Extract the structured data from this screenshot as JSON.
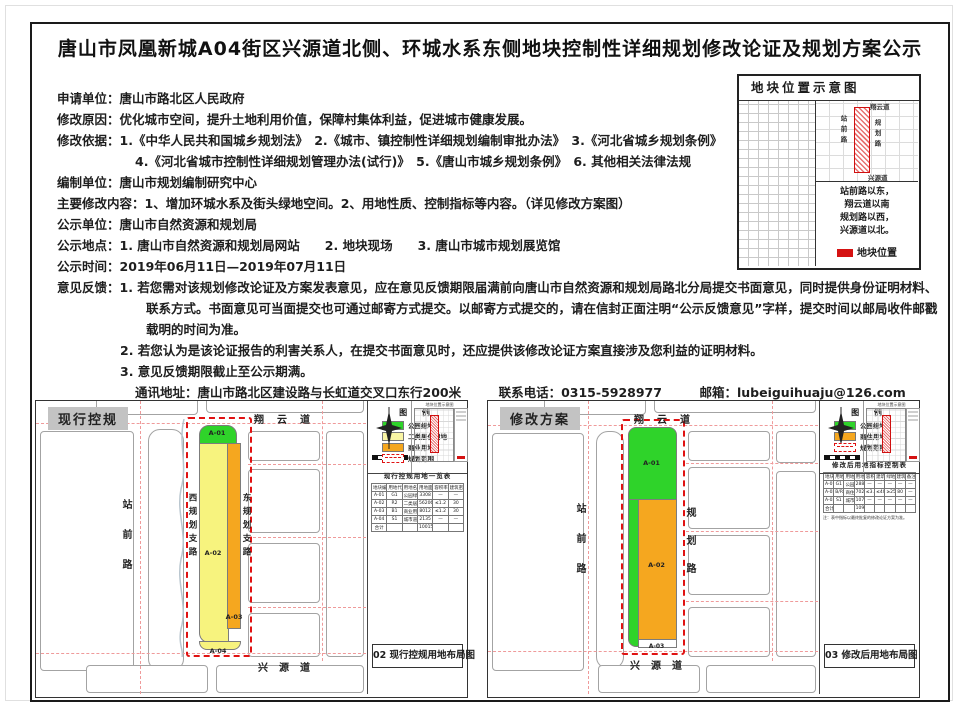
{
  "page": {
    "title": "唐山市凤凰新城A04街区兴源道北侧、环城水系东侧地块控制性详细规划修改论证及规划方案公示"
  },
  "body": {
    "lines": [
      {
        "text": "申请单位：唐山市路北区人民政府"
      },
      {
        "text": "修改原因：优化城市空间，提升土地利用价值，保障村集体利益，促进城市健康发展。"
      },
      {
        "text": "修改依据：1.《中华人民共和国城乡规划法》　2.《城市、镇控制性详细规划编制审批办法》　3.《河北省城乡规划条例》"
      },
      {
        "text": "4.《河北省城市控制性详细规划管理办法(试行)》　5.《唐山市城乡规划条例》　6. 其他相关法律法规"
      },
      {
        "text": "编制单位：唐山市规划编制研究中心"
      },
      {
        "text": "主要修改内容：1、增加环城水系及街头绿地空间。2、用地性质、控制指标等内容。（详见修改方案图）"
      },
      {
        "text": "公示单位：唐山市自然资源和规划局"
      },
      {
        "text": "公示地点：1. 唐山市自然资源和规划局网站　　2. 地块现场　　3. 唐山市城市规划展览馆"
      },
      {
        "text": "公示时间：2019年06月11日—2019年07月11日"
      },
      {
        "text": "意见反馈：1. 若您需对该规划修改论证及方案发表意见，应在意见反馈期限届满前向唐山市自然资源和规划局路北分局提交书面意见，同时提供身份证明材料、"
      },
      {
        "text": "联系方式。书面意见可当面提交也可通过邮寄方式提交。以邮寄方式提交的，请在信封正面注明“公示反馈意见”字样，提交时间以邮局收件邮戳"
      },
      {
        "text": "载明的时间为准。"
      },
      {
        "text": "2. 若您认为是该论证报告的利害关系人，在提交书面意见时，还应提供该修改论证方案直接涉及您利益的证明材料。"
      },
      {
        "text": "3. 意见反馈期限截止至公示期满。"
      },
      {
        "text": "通讯地址：唐山市路北区建设路与长虹道交叉口东行200米　　　联系电话：0315-5928977　　　邮箱：lubeiguihuaju@126.com"
      }
    ]
  },
  "location_panel": {
    "title": "地块位置示意图",
    "inset_roads": {
      "top": "翔云道",
      "left": "站前路",
      "right": "规划路",
      "bottom": "兴源道"
    },
    "description_lines": [
      "站前路以东，",
      "翔云道以南",
      "规划路以西，",
      "兴源道以北。"
    ],
    "legend_label": "地块位置"
  },
  "left_panel": {
    "badge": "现行控规",
    "roads": {
      "top": "翔云道",
      "bottom": "兴源道",
      "left": "站前路",
      "inner_left": "西规划支路",
      "inner_right": "东规划支路"
    },
    "parcels": [
      {
        "id": "A-01"
      },
      {
        "id": "A-02"
      },
      {
        "id": "A-03"
      },
      {
        "id": "A-04"
      }
    ],
    "minimap": {
      "title": "地块位置示意图"
    },
    "legend": {
      "title": "图 例",
      "items": [
        {
          "label": "公园绿地",
          "color": "#2fd32a"
        },
        {
          "label": "二类居住用地",
          "color": "#f9f5a4"
        },
        {
          "label": "商业用地",
          "color": "#f5a71f"
        },
        {
          "label": "规划范围",
          "color": "#e01212"
        }
      ]
    },
    "table": {
      "title": "现行控规用地一览表",
      "headers": [
        "地块编号",
        "用地代码",
        "用地名称",
        "用地面积(㎡)",
        "容积率",
        "建筑密度(%)"
      ],
      "rows": [
        [
          "A-01",
          "G1",
          "公园绿地",
          "3308",
          "—",
          "—"
        ],
        [
          "A-02",
          "R2",
          "二类居住用地",
          "56206",
          "≤1.2",
          "30"
        ],
        [
          "A-03",
          "B1",
          "商业用地",
          "8012",
          "≤1.2",
          "30"
        ],
        [
          "A-04",
          "S1",
          "城市道路用地",
          "2135",
          "—",
          "—"
        ],
        [
          "合计",
          "",
          "",
          "100153",
          "",
          ""
        ]
      ]
    },
    "caption": "02 现行控规用地布局图"
  },
  "right_panel": {
    "badge": "修改方案",
    "roads": {
      "top": "翔云道",
      "bottom": "兴源道",
      "left": "站前路",
      "right": "规划路"
    },
    "parcels": [
      {
        "id": "A-01"
      },
      {
        "id": "A-02"
      },
      {
        "id": "A-03"
      }
    ],
    "minimap": {
      "title": "地块位置示意图"
    },
    "legend": {
      "title": "图 例",
      "items": [
        {
          "label": "公园绿地",
          "color": "#2fd32a"
        },
        {
          "label": "商住用地",
          "color": "#f5a71f"
        },
        {
          "label": "规划范围",
          "color": "#e01212"
        }
      ]
    },
    "table": {
      "title": "修改后用地指标控制表",
      "headers": [
        "地块编号",
        "用地代码",
        "用地名称",
        "用地面积(㎡)",
        "容积率",
        "建筑密度",
        "绿地率",
        "建筑高度",
        "备注"
      ],
      "rows": [
        [
          "A-01",
          "G1",
          "公园绿地",
          "28878",
          "—",
          "—",
          "—",
          "—",
          "—"
        ],
        [
          "A-02",
          "B/R",
          "商住用地",
          "70261",
          "≤3.0",
          "≤40",
          "≥25",
          "80",
          "—"
        ],
        [
          "A-03",
          "S1",
          "城市道路用地",
          "10700",
          "—",
          "—",
          "—",
          "—",
          "—"
        ],
        [
          "合计",
          "",
          "",
          "109839",
          "",
          "",
          "",
          "",
          ""
        ]
      ],
      "note": "注：表中指标以最终批复的修改论证方案为准。"
    },
    "caption": "03 修改后用地布局图"
  },
  "colors": {
    "boundary_red": "#e01212",
    "parcel_green": "#2fd32a",
    "parcel_yellow": "#f7f37e",
    "parcel_orange": "#f5a71f",
    "road_centerline_red": "#ef9a9a",
    "badge_gray": "#c3c3c3"
  }
}
